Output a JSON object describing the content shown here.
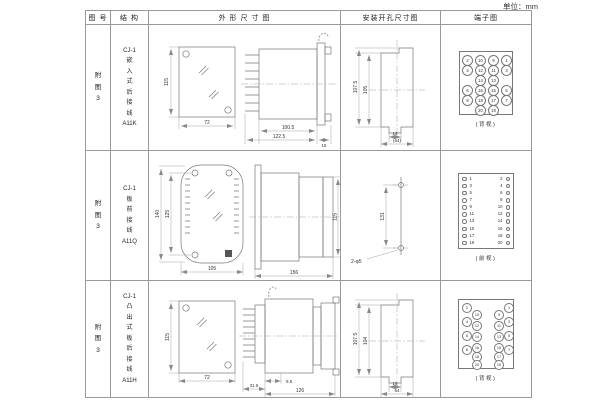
{
  "unit_label": "单位：mm",
  "header": {
    "fig_no": "图 号",
    "structure": "结 构",
    "outline": "外 形 尺 寸 图",
    "mounting": "安装开孔尺寸图",
    "terminal": "端子图"
  },
  "rows": [
    {
      "fig_no": "附\n图\n3",
      "structure": "CJ-1\n嵌\n入\n式\n后\n接\n线\nA11K",
      "outline_dims": {
        "front_h": "115",
        "front_w": "72",
        "d1": "100.5",
        "d2": "122.5",
        "d3": "15"
      },
      "mounting_dims": {
        "outer_h": "107.5",
        "inner_h": "105",
        "slot_w": "16",
        "overall_w": "(64)"
      },
      "terminal": {
        "view": "(背视)",
        "grid": [
          [
            "2",
            "10",
            "9",
            "1"
          ],
          [
            "4",
            "12",
            "11",
            "3"
          ],
          [
            "",
            "14",
            "13",
            ""
          ],
          [
            "6",
            "16",
            "15",
            "5"
          ],
          [
            "8",
            "18",
            "17",
            "7"
          ],
          [
            "",
            "20",
            "19",
            ""
          ]
        ]
      }
    },
    {
      "fig_no": "附\n图\n3",
      "structure": "CJ-1\n板\n前\n接\n线\nA11Q",
      "outline_dims": {
        "front_h_outer": "140",
        "front_h_inner": "125",
        "front_w": "105",
        "side_w": "156",
        "side_h": "115"
      },
      "mounting_dims": {
        "hole_span": "131",
        "hole_label": "2-φ5"
      },
      "terminal": {
        "view": "(前视)",
        "left": [
          "1",
          "3",
          "5",
          "7",
          "9",
          "11",
          "13",
          "15",
          "17",
          "19"
        ],
        "right": [
          "2",
          "4",
          "6",
          "8",
          "10",
          "12",
          "14",
          "16",
          "18",
          "20"
        ]
      }
    },
    {
      "fig_no": "附\n图\n3",
      "structure": "CJ-1\n凸\n出\n式\n板\n后\n接\n线\nA11H",
      "outline_dims": {
        "front_h": "115",
        "front_w": "72",
        "d1": "31.5",
        "d2": "9.5",
        "d3": "126"
      },
      "mounting_dims": {
        "outer_h": "107.5",
        "inner_h": "104",
        "slot_w": "16",
        "overall_w": "64"
      },
      "terminal": {
        "view": "(背视)",
        "left_outer": [
          "2",
          "4",
          "6",
          "8"
        ],
        "left_inner": [
          "10",
          "12",
          "14",
          "16",
          "18",
          "20"
        ],
        "right_outer": [
          "1",
          "3",
          "5",
          "7"
        ],
        "right_inner": [
          "9",
          "11",
          "13",
          "15",
          "17",
          "19"
        ]
      }
    }
  ]
}
